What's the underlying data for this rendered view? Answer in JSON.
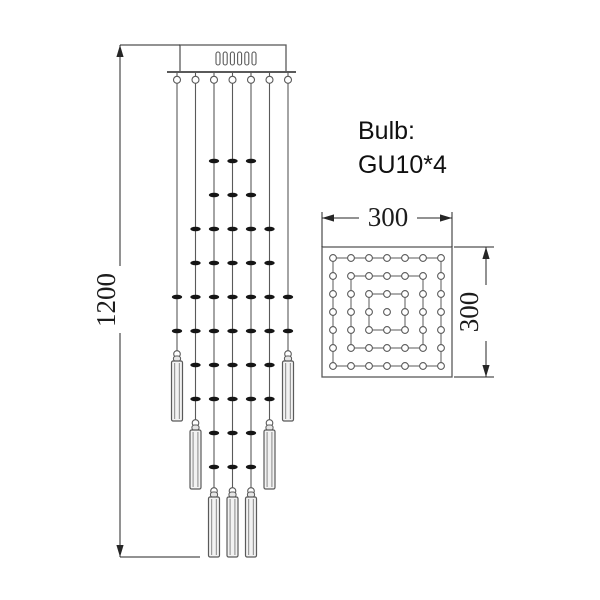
{
  "labels": {
    "bulb_line1": "Bulb:",
    "bulb_line2": "GU10*4",
    "overall_height": "1200",
    "top_width": "300",
    "top_depth": "300"
  },
  "colors": {
    "line": "#5a5a5a",
    "dim": "#262626",
    "bead": "#151515",
    "pendant_fill": "#f2f2f2",
    "pendant_shade": "#9a9a9a"
  },
  "front_view": {
    "canopy": {
      "x": 180,
      "y": 45,
      "w": 106,
      "h": 27,
      "slot_count": 6,
      "slot_w": 4,
      "slot_h": 13,
      "slot_gap": 3.2,
      "slot_y": 52,
      "slot_center_x": 236
    },
    "plate": {
      "x1": 167,
      "x2": 296,
      "y": 72
    },
    "wire_x": [
      177,
      195.5,
      214,
      232.5,
      251,
      269.5,
      288
    ],
    "hook_r": 3.5,
    "bead": {
      "rx": 5.2,
      "ry": 2.3
    },
    "bead_rows": [
      {
        "y": 161,
        "wires": [
          2,
          3,
          4
        ]
      },
      {
        "y": 195,
        "wires": [
          2,
          3,
          4
        ]
      },
      {
        "y": 229,
        "wires": [
          1,
          2,
          3,
          4,
          5
        ]
      },
      {
        "y": 263,
        "wires": [
          1,
          2,
          3,
          4,
          5
        ]
      },
      {
        "y": 297,
        "wires": [
          0,
          1,
          2,
          3,
          4,
          5,
          6
        ]
      },
      {
        "y": 331,
        "wires": [
          0,
          1,
          2,
          3,
          4,
          5,
          6
        ]
      },
      {
        "y": 365,
        "wires": [
          1,
          2,
          3,
          4,
          5
        ]
      },
      {
        "y": 399,
        "wires": [
          1,
          2,
          3,
          4,
          5
        ]
      },
      {
        "y": 433,
        "wires": [
          2,
          3,
          4
        ]
      },
      {
        "y": 467,
        "wires": [
          2,
          3,
          4
        ]
      }
    ],
    "pendant_groups": [
      {
        "wires": [
          0,
          6
        ],
        "hook_y": 354,
        "body_top": 361,
        "body_bottom": 421
      },
      {
        "wires": [
          1,
          5
        ],
        "hook_y": 423,
        "body_top": 430,
        "body_bottom": 489
      },
      {
        "wires": [
          2,
          3,
          4
        ],
        "hook_y": 491,
        "body_top": 497,
        "body_bottom": 557
      }
    ],
    "pendant_w": 11
  },
  "top_view": {
    "x": 322,
    "y": 247,
    "size": 130,
    "grid": 7,
    "inset": 11,
    "dot_r": 3.4
  },
  "dims": {
    "height": {
      "x": 120,
      "y1": 45,
      "y2": 557,
      "gap": [
        266,
        333
      ],
      "ext_top_x2": 180,
      "ext_bot_x2": 200
    },
    "width": {
      "y": 218,
      "x1": 322,
      "x2": 452,
      "gap": [
        359,
        417
      ],
      "ext_y1": 212
    },
    "depth": {
      "x": 486,
      "y1": 247,
      "y2": 377,
      "gap": [
        285,
        341
      ],
      "ext_x1": 454,
      "ext_x2": 494
    }
  }
}
